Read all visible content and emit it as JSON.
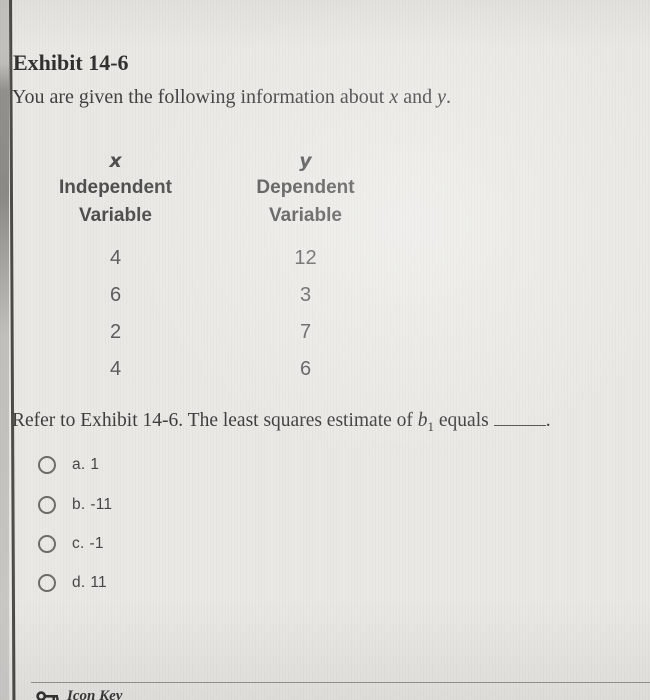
{
  "exhibit": {
    "title": "Exhibit 14-6",
    "intro_prefix": "You are given the following information about ",
    "intro_var1": "x",
    "intro_middle": " and ",
    "intro_var2": "y",
    "intro_end": "."
  },
  "table": {
    "columns": [
      {
        "symbol": "x",
        "line1": "Independent",
        "line2": "Variable"
      },
      {
        "symbol": "y",
        "line1": "Dependent",
        "line2": "Variable"
      }
    ],
    "rows": [
      {
        "x": "4",
        "y": "12"
      },
      {
        "x": "6",
        "y": "3"
      },
      {
        "x": "2",
        "y": "7"
      },
      {
        "x": "4",
        "y": "6"
      }
    ]
  },
  "question": {
    "prefix": "Refer to Exhibit 14-6. The least squares estimate of ",
    "var": "b",
    "sub": "1",
    "middle": " equals",
    "end": "."
  },
  "options": [
    {
      "letter": "a.",
      "value": "1",
      "selected": false
    },
    {
      "letter": "b.",
      "value": "-11",
      "selected": false
    },
    {
      "letter": "c.",
      "value": "-1",
      "selected": false
    },
    {
      "letter": "d.",
      "value": "11",
      "selected": false
    }
  ],
  "footer": {
    "label": "Icon Key"
  },
  "colors": {
    "background": "#e9e8e4",
    "edge_strip": "#8a8984",
    "border_line": "#4a4944",
    "title_text": "#2e2e2d",
    "body_text": "#3d3d3b",
    "table_text": "#5a5a58",
    "option_text": "#434341",
    "radio_border": "#6a6a66",
    "divider": "#96958f"
  }
}
